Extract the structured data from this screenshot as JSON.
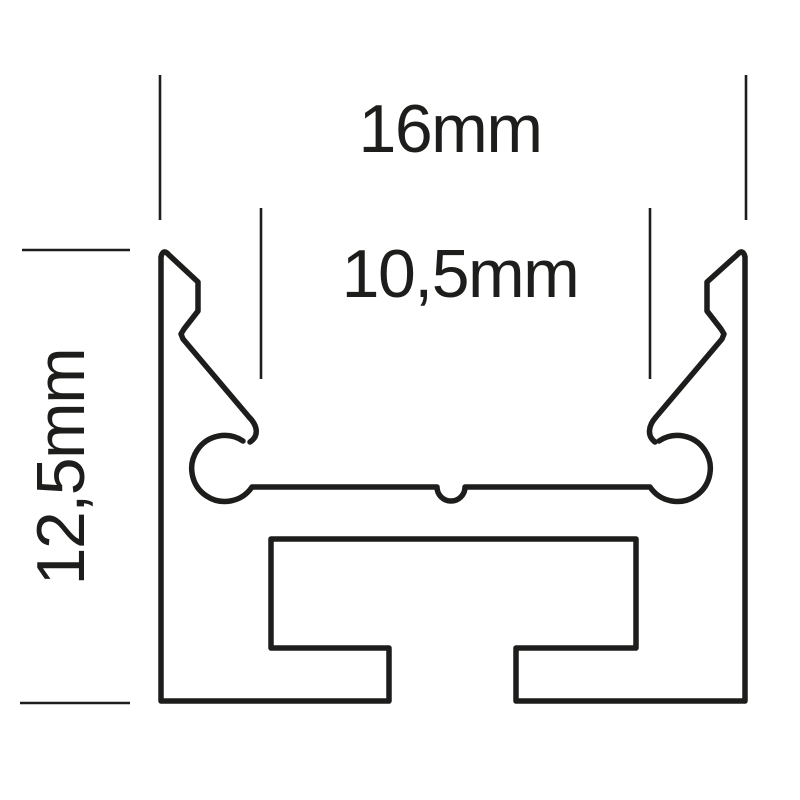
{
  "diagram": {
    "type": "technical-cross-section",
    "subject": "aluminium LED profile cross-section with dimension annotations",
    "labels": {
      "top_width": "16mm",
      "inner_width": "10,5mm",
      "height": "12,5mm"
    },
    "colors": {
      "line": "#1d1d1b",
      "background": "#ffffff"
    }
  }
}
